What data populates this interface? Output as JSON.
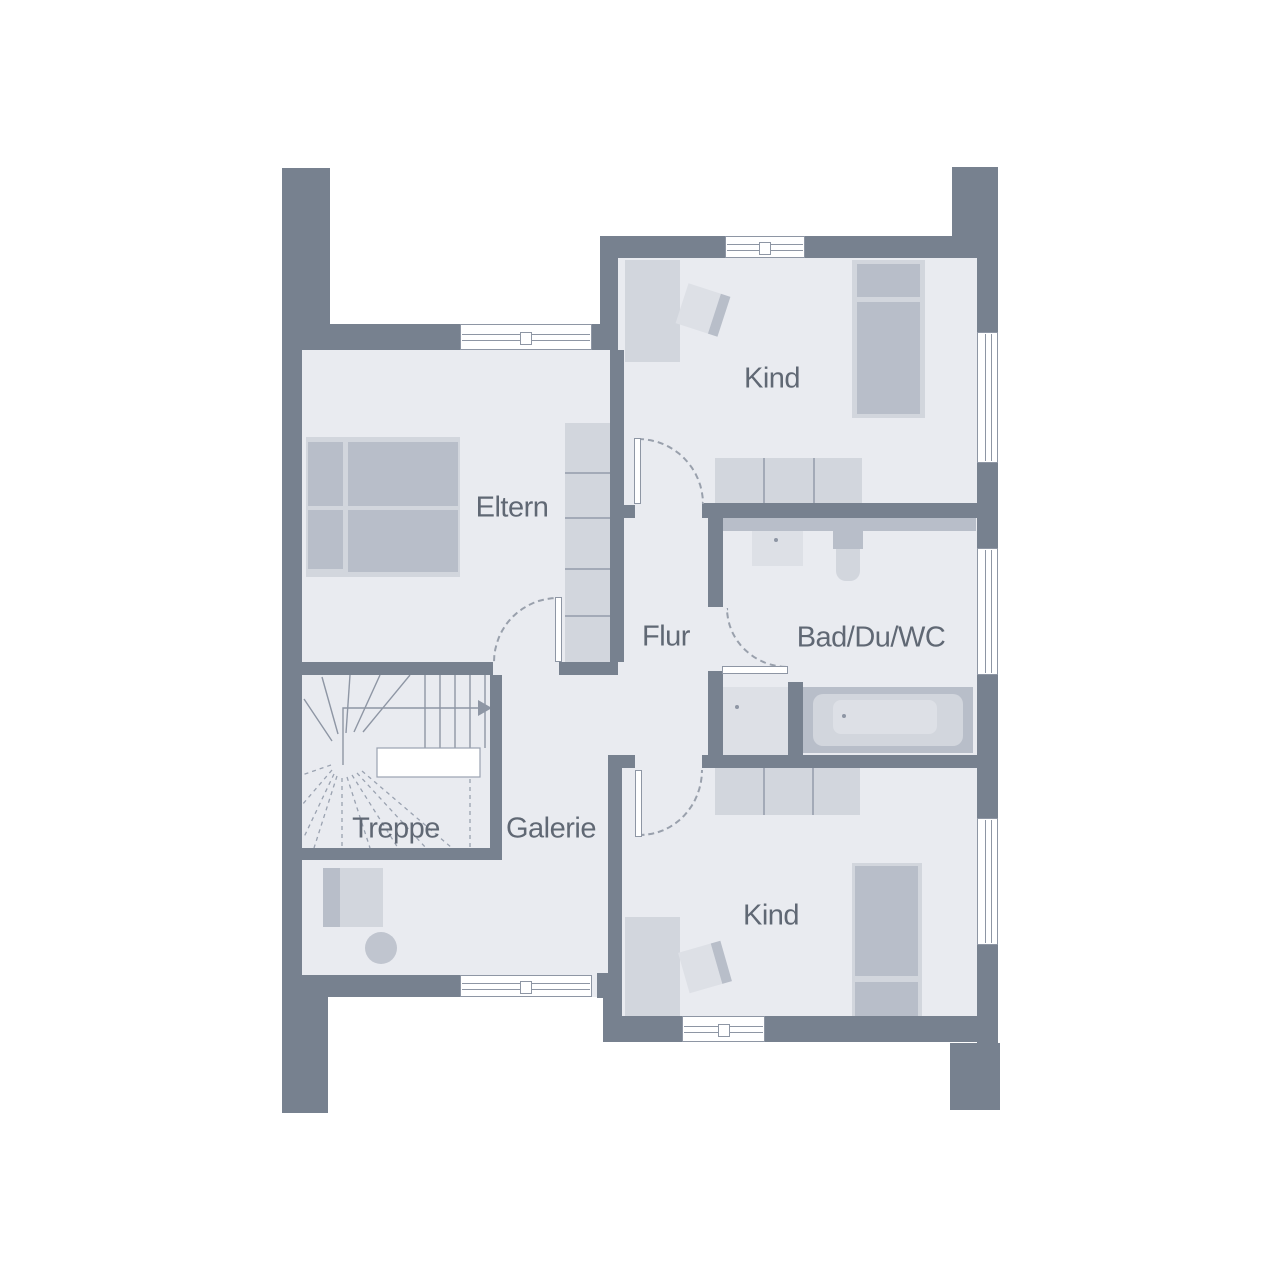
{
  "colors": {
    "wall": "#77818F",
    "floor": "#E9EBF0",
    "furniture": "#B8BEC9",
    "furniture_light": "#D2D6DD",
    "furniture_lighter": "#DDE0E6",
    "line": "#8E96A4",
    "line2": "#A3AAB7",
    "dash": "#99A0AC",
    "label": "#606874"
  },
  "rooms": [
    {
      "id": "kind-top",
      "label": "Kind"
    },
    {
      "id": "eltern",
      "label": "Eltern"
    },
    {
      "id": "flur",
      "label": "Flur"
    },
    {
      "id": "bad-du-wc",
      "label": "Bad/Du/WC"
    },
    {
      "id": "treppe",
      "label": "Treppe"
    },
    {
      "id": "galerie",
      "label": "Galerie"
    },
    {
      "id": "kind-bottom",
      "label": "Kind"
    }
  ]
}
